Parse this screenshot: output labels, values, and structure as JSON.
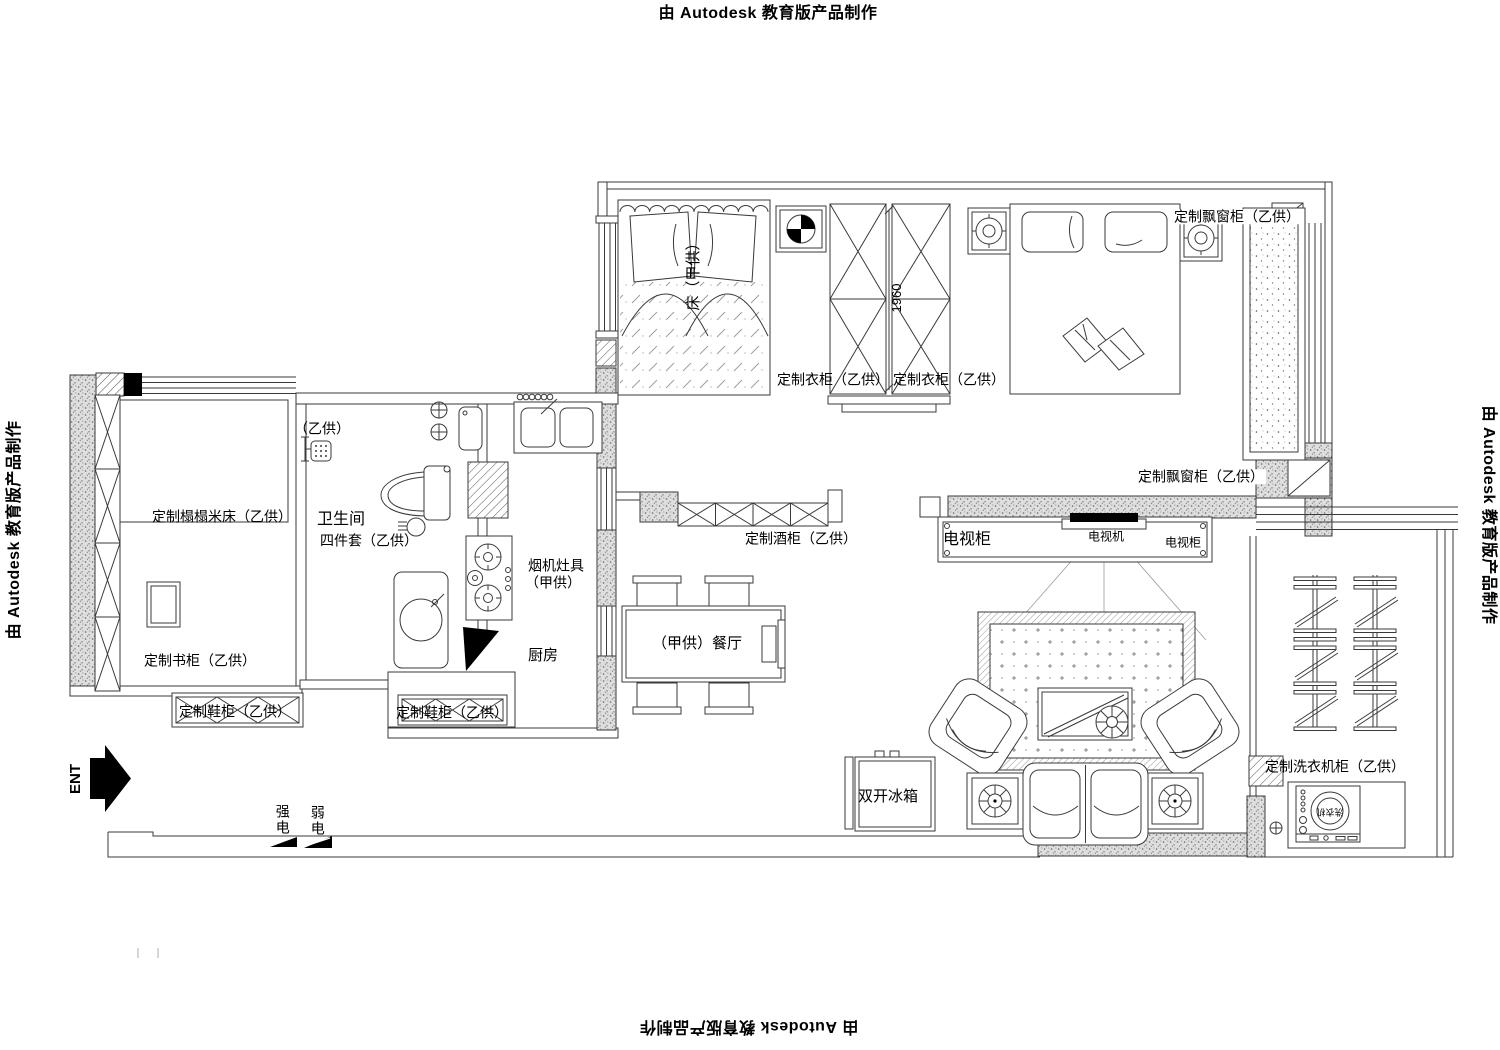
{
  "watermarks": {
    "top": "由 Autodesk 教育版产品制作",
    "left": "由 Autodesk 教育版产品制作",
    "right": "由 Autodesk 教育版产品制作",
    "bottom": "由 Autodesk 教育版产品制作"
  },
  "rooms": {
    "bathroom": "卫生间",
    "kitchen": "厨房",
    "dining": "（甲供）餐厅"
  },
  "labels": {
    "tatami_bed": "定制榻榻米床（乙供）",
    "bookcase": "定制书柜（乙供）",
    "shoe_cabinet_left": "定制鞋柜（乙供）",
    "shoe_cabinet_hall": "定制鞋柜（乙供）",
    "shower_set": "（乙供）",
    "bath_four_piece": "四件套（乙供）",
    "range_hood_line1": "烟机灶具",
    "range_hood_line2": "（甲供）",
    "main_bed": "床（甲供）",
    "wardrobe_left": "定制衣柜（乙供）",
    "wardrobe_right": "定制衣柜（乙供）",
    "bay_window_top": "定制飘窗柜（乙供）",
    "bay_window_mid": "定制飘窗柜（乙供）",
    "wine_cabinet": "定制酒柜（乙供）",
    "tv_cabinet_main": "电视柜",
    "tv_set": "电视机",
    "tv_cabinet_small": "电视柜",
    "fridge": "双开冰箱",
    "washer_cabinet": "定制洗衣机柜（乙供）",
    "washer": "洗衣机"
  },
  "annotations": {
    "entry": "ENT",
    "strong_power": "强电",
    "weak_power": "弱电",
    "dim_1960": "1960"
  }
}
